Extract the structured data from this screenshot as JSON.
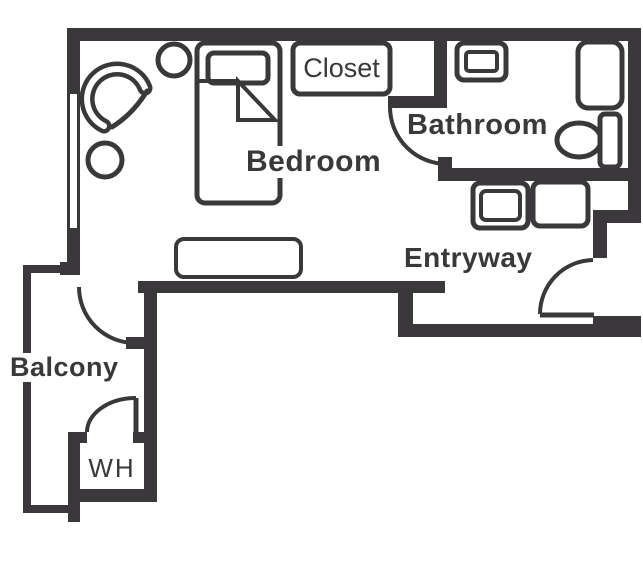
{
  "plan": {
    "type": "apartment-floor-plan",
    "colors": {
      "wall": "#3a383a",
      "background": "#ffffff",
      "text": "#3a383a"
    },
    "rooms": [
      {
        "id": "bedroom",
        "label": "Bedroom"
      },
      {
        "id": "closet",
        "label": "Closet"
      },
      {
        "id": "bathroom",
        "label": "Bathroom"
      },
      {
        "id": "entryway",
        "label": "Entryway"
      },
      {
        "id": "balcony",
        "label": "Balcony"
      },
      {
        "id": "water-heater",
        "label": "WH"
      }
    ],
    "doors": [
      "bathroom-door",
      "balcony-door",
      "entry-door",
      "water-heater-door"
    ],
    "fixtures": [
      "bed",
      "pillow",
      "blanket-fold",
      "armchair",
      "side-table",
      "side-table",
      "bench",
      "window",
      "sink",
      "shower",
      "toilet",
      "washer",
      "dryer"
    ]
  }
}
